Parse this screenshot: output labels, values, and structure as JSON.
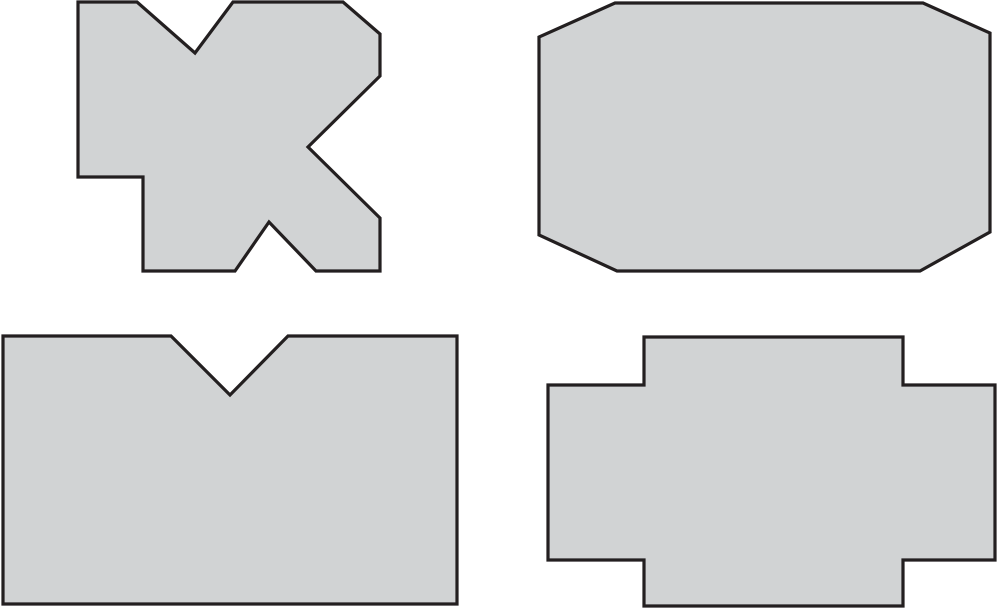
{
  "canvas": {
    "width": 1000,
    "height": 610,
    "background_color": "#ffffff"
  },
  "style": {
    "shape_fill_color": "#d1d3d4",
    "shape_stroke_color": "#231f20",
    "shape_stroke_width": 3.2
  },
  "shapes": [
    {
      "id": "shape-top-left-irregular-cross",
      "description": "irregular polygon with top V notch, cut corner, left-pointing side notch, bottom peak notch and lower-left step",
      "points": [
        [
          78,
          2
        ],
        [
          137,
          2
        ],
        [
          195,
          53
        ],
        [
          233,
          2
        ],
        [
          343,
          2
        ],
        [
          380,
          34
        ],
        [
          380,
          76
        ],
        [
          308,
          147
        ],
        [
          380,
          218
        ],
        [
          380,
          271
        ],
        [
          316,
          271
        ],
        [
          269,
          222
        ],
        [
          235,
          271
        ],
        [
          143,
          271
        ],
        [
          143,
          177
        ],
        [
          78,
          177
        ]
      ]
    },
    {
      "id": "shape-top-right-octagon",
      "description": "rectangle with four cut corners (octagon)",
      "points": [
        [
          615,
          3
        ],
        [
          923,
          3
        ],
        [
          990,
          33
        ],
        [
          990,
          232
        ],
        [
          920,
          271
        ],
        [
          617,
          271
        ],
        [
          539,
          235
        ],
        [
          539,
          37
        ]
      ]
    },
    {
      "id": "shape-bottom-left-notched-rectangle",
      "description": "rectangle with triangular V notch in top edge",
      "points": [
        [
          3,
          336
        ],
        [
          171,
          336
        ],
        [
          230,
          395
        ],
        [
          288,
          336
        ],
        [
          457,
          336
        ],
        [
          457,
          604
        ],
        [
          3,
          604
        ]
      ]
    },
    {
      "id": "shape-bottom-right-cross",
      "description": "plus/cross shape: tall center rectangle with left and right arms",
      "points": [
        [
          644,
          337
        ],
        [
          903,
          337
        ],
        [
          903,
          385
        ],
        [
          995,
          385
        ],
        [
          995,
          560
        ],
        [
          903,
          560
        ],
        [
          903,
          606
        ],
        [
          644,
          606
        ],
        [
          644,
          560
        ],
        [
          548,
          560
        ],
        [
          548,
          385
        ],
        [
          644,
          385
        ]
      ]
    }
  ]
}
